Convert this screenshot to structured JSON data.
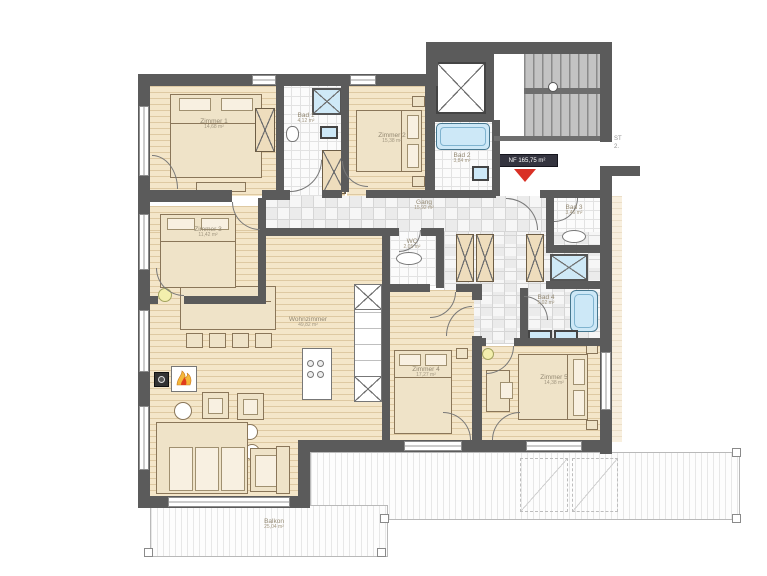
{
  "marker": {
    "label": "NF 165,75 m²"
  },
  "side_note": {
    "line1": "ST",
    "line2": "2."
  },
  "rooms": {
    "zimmer1": {
      "name": "Zimmer 1",
      "area": "14,68 m²"
    },
    "bad1": {
      "name": "Bad 1",
      "area": "4,12 m²"
    },
    "zimmer2": {
      "name": "Zimmer 2",
      "area": "15,38 m²"
    },
    "bad2": {
      "name": "Bad 2",
      "area": "3,84 m²"
    },
    "gang": {
      "name": "Gang",
      "area": "15,92 m²"
    },
    "zimmer3": {
      "name": "Zimmer 3",
      "area": "11,42 m²"
    },
    "wc": {
      "name": "WC",
      "area": "2,05 m²"
    },
    "bad3": {
      "name": "Bad 3",
      "area": "3,46 m²"
    },
    "bad4": {
      "name": "Bad 4",
      "area": "5,02 m²"
    },
    "wohnzimmer": {
      "name": "Wohnzimmer",
      "area": "49,82 m²"
    },
    "zimmer4": {
      "name": "Zimmer 4",
      "area": "17,27 m²"
    },
    "zimmer5": {
      "name": "Zimmer 5",
      "area": "14,38 m²"
    },
    "balkon": {
      "name": "Balkon",
      "area": "25,04 m²"
    }
  },
  "colors": {
    "wall": "#5b5b5b",
    "wood": "#f4e6c9",
    "water_blue": "#cde8f7",
    "cabinet_tan": "#eeddbd",
    "marker_red": "#d93025"
  }
}
